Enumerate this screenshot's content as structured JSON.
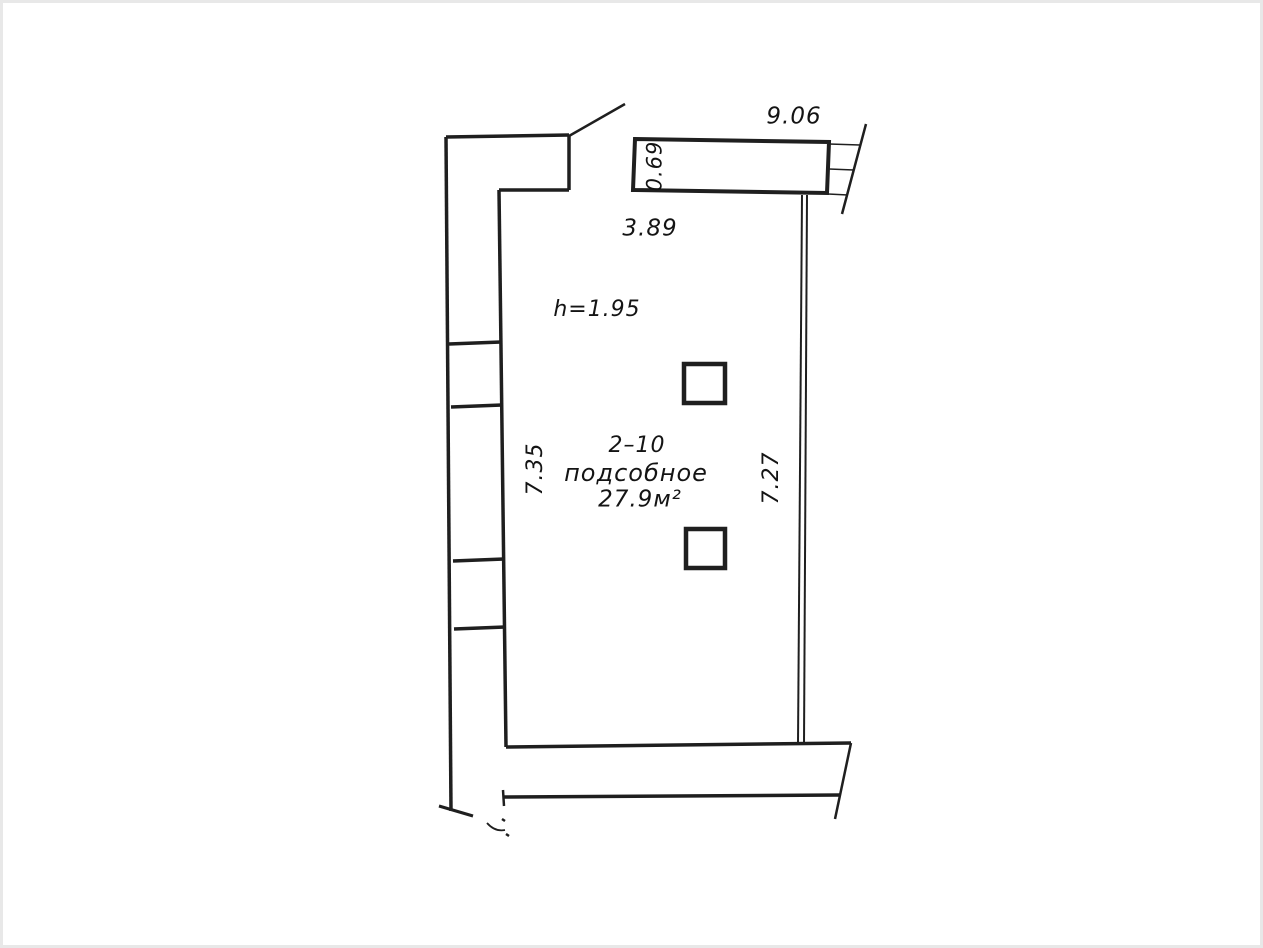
{
  "page": {
    "kind": "scanned floor plan page",
    "paper_color": "#ffffff",
    "frame_color": "#e8e8e8",
    "ink_color": "#1f1f1f"
  },
  "floorplan": {
    "room": {
      "number": "2–10",
      "name": "подсобное",
      "area": "27.9м²",
      "ceiling_height": "h=1.95"
    },
    "dimensions": {
      "overall_width": "9.06",
      "opening_depth": "0.69",
      "inner_width": "3.89",
      "left_wall_length": "7.35",
      "right_wall_length": "7.27"
    }
  }
}
